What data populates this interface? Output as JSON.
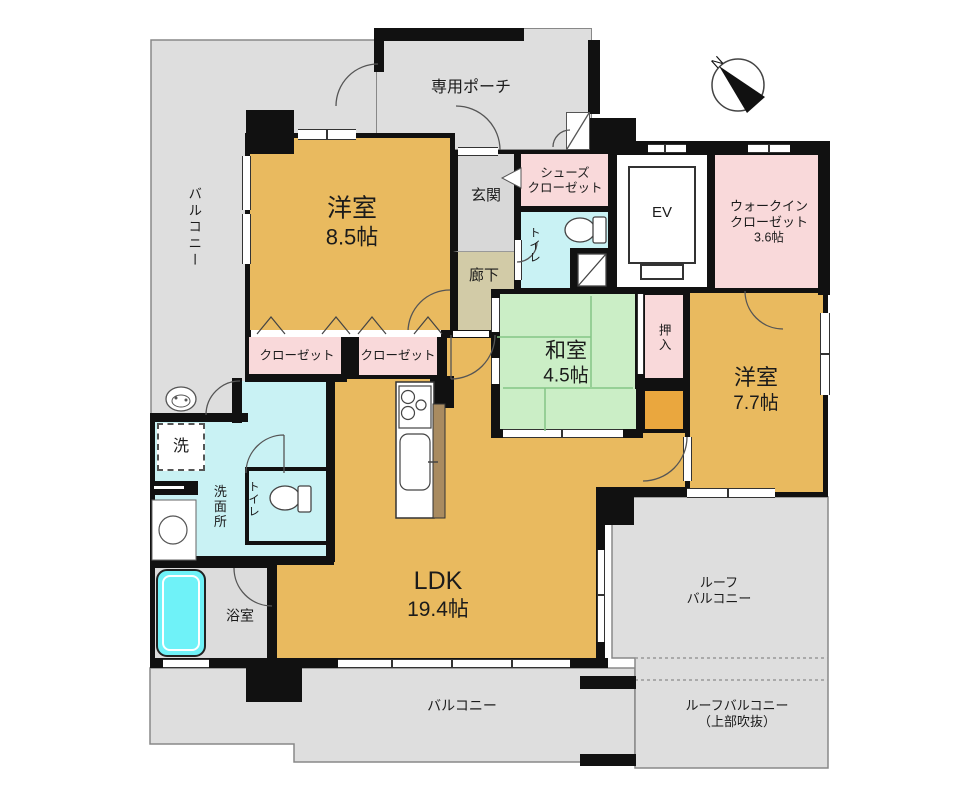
{
  "compass": {
    "north_label": "N"
  },
  "rooms": {
    "balcony_left": {
      "label": "バルコニー"
    },
    "private_porch": {
      "label": "専用ポーチ"
    },
    "western_room_1": {
      "name": "洋室",
      "size": "8.5帖"
    },
    "genkan": {
      "label": "玄関"
    },
    "shoes_closet": {
      "line1": "シューズ",
      "line2": "クローゼット"
    },
    "toilet_1": {
      "label": "トイレ"
    },
    "corridor": {
      "label": "廊下"
    },
    "elevator": {
      "label": "EV"
    },
    "walk_in_closet": {
      "line1": "ウォークイン",
      "line2": "クローゼット",
      "size": "3.6帖"
    },
    "japanese_room": {
      "name": "和室",
      "size": "4.5帖"
    },
    "oshiire": {
      "label": "押入"
    },
    "western_room_2": {
      "name": "洋室",
      "size": "7.7帖"
    },
    "closet_1": {
      "label": "クローゼット"
    },
    "closet_2": {
      "label": "クローゼット"
    },
    "washer": {
      "label": "洗"
    },
    "washroom": {
      "label": "洗面所"
    },
    "toilet_2": {
      "label": "トイレ"
    },
    "bathroom": {
      "label": "浴室"
    },
    "ldk": {
      "name": "LDK",
      "size": "19.4帖"
    },
    "balcony_bottom": {
      "label": "バルコニー"
    },
    "roof_balcony": {
      "line1": "ルーフ",
      "line2": "バルコニー"
    },
    "roof_balcony_void": {
      "line1": "ルーフバルコニー",
      "line2": "（上部吹抜）"
    }
  },
  "colors": {
    "room_gold": "#E9BA5F",
    "nook_orange": "#EAA73E",
    "tatami_green": "#CBEEC6",
    "tatami_line": "#84C586",
    "closet_pink": "#F9D9DA",
    "water_cyan": "#C9F2F4",
    "tub_cyan": "#6FF2F8",
    "balcony_gray": "#DEDEDE",
    "genkan_gray": "#D8D8D8",
    "corridor_beige": "#D2CBA7",
    "counter_brown": "#A98B60",
    "wall_black": "#111111"
  }
}
